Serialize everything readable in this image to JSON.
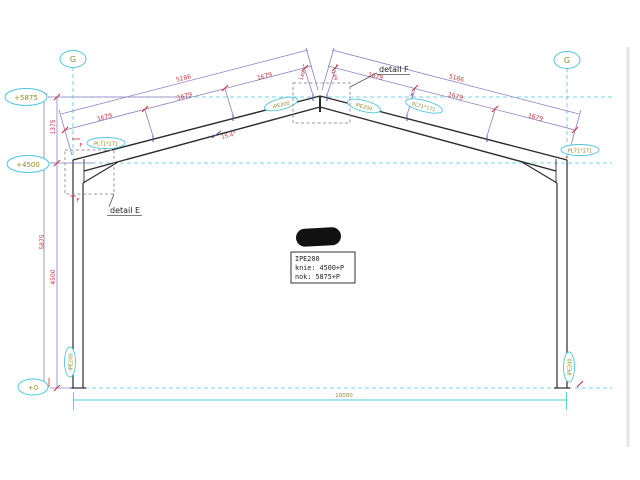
{
  "drawing": {
    "grid_marker_left": "G",
    "grid_marker_right": "G",
    "level_top": "+5875",
    "level_knee": "+4500",
    "level_base": "+0",
    "dim_total_height": "5875",
    "dim_upper_height": "1375",
    "dim_knee_height": "4500",
    "dim_rafter_total_left": "5186",
    "dim_rafter_total_right": "5186",
    "dim_rafter_segment": "1679",
    "dim_apex_segment": "149",
    "dim_span": "10000",
    "roof_angle": "15.4°",
    "label_rafter_left": "IPE200",
    "label_rafter_right": "IPE200",
    "label_column_left": "IPE200",
    "label_column_right": "IPE200",
    "label_plate_left_knee": "PL71*171",
    "label_plate_right_knee": "PL71*171",
    "label_plate_apex": "PL71*171",
    "weld_mark": "F",
    "detail_e_label": "detail E",
    "detail_f_label": "detail F",
    "info_box": {
      "line1": "IPE200",
      "line2": "knie: 4500+P",
      "line3": "nok:  5875+P"
    },
    "colors": {
      "cyan": "#4fc7dc",
      "purple": "#8d7fc4",
      "red": "#cc3333",
      "olive": "#8c8c28",
      "steel": "#2b2b2b"
    }
  }
}
